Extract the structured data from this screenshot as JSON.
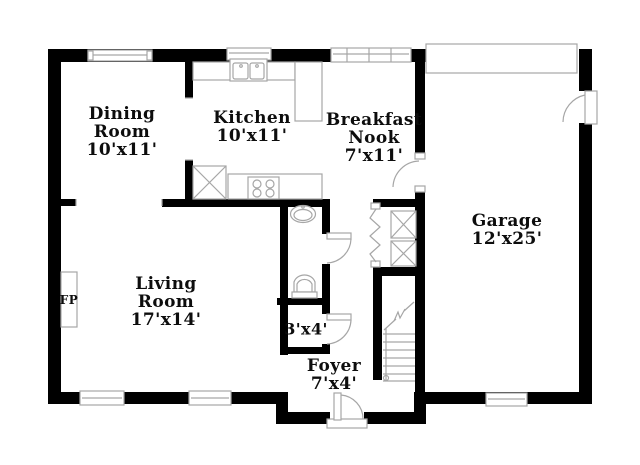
{
  "rooms": {
    "dining": {
      "name": "Dining Room",
      "dims": "10'x11'"
    },
    "kitchen": {
      "name": "Kitchen",
      "dims": "10'x11'"
    },
    "breakfast": {
      "name": "Breakfast Nook",
      "dims": "7'x11'"
    },
    "garage": {
      "name": "Garage",
      "dims": "12'x25'"
    },
    "living": {
      "name": "Living Room",
      "dims": "17'x14'"
    },
    "closet": {
      "dims": "3'x4'"
    },
    "foyer": {
      "name": "Foyer",
      "dims": "7'x4'"
    },
    "fireplace": {
      "label": "FP"
    }
  },
  "colors": {
    "wall": "#000000",
    "fixture_outline": "#a6a6a6",
    "text": "#0d0d0d",
    "background": "#ffffff"
  },
  "fixtures": [
    "kitchen-sink",
    "range-stove",
    "pantry-cabinet",
    "kitchen-counter",
    "bathroom-sink",
    "toilet",
    "fireplace",
    "staircase",
    "bifold-closet",
    "utility-units",
    "garage-overhead-door",
    "entry-door-swing",
    "garage-side-door-swing",
    "windows"
  ]
}
